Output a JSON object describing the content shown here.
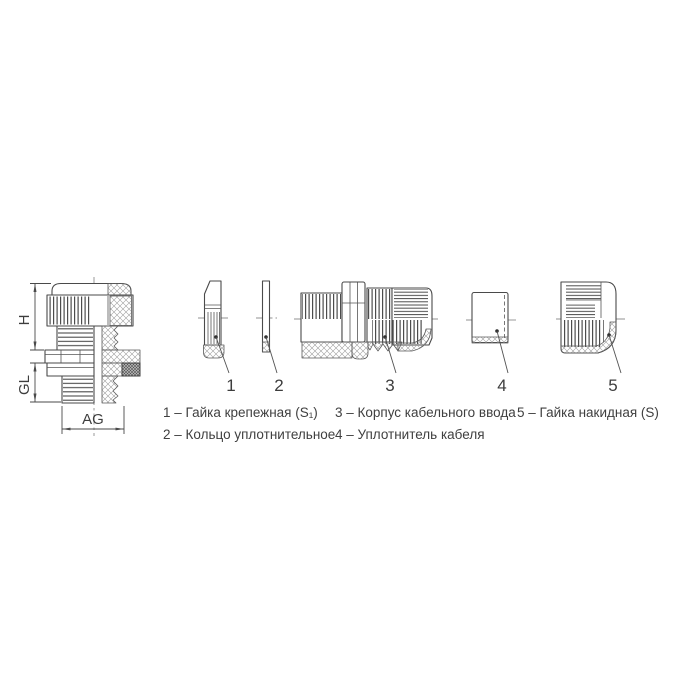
{
  "drawing": {
    "dimensions": {
      "height": "H",
      "thread_length": "GL",
      "thread_size": "AG"
    },
    "callouts": [
      "1",
      "2",
      "3",
      "4",
      "5"
    ]
  },
  "legend": {
    "col1": [
      "1 – Гайка крепежная (S₁)",
      "2 – Кольцо уплотнительное"
    ],
    "col2": [
      "3 – Корпус кабельного ввода",
      "4 – Уплотнитель кабеля"
    ],
    "col3": [
      "5 – Гайка накидная (S)"
    ]
  }
}
